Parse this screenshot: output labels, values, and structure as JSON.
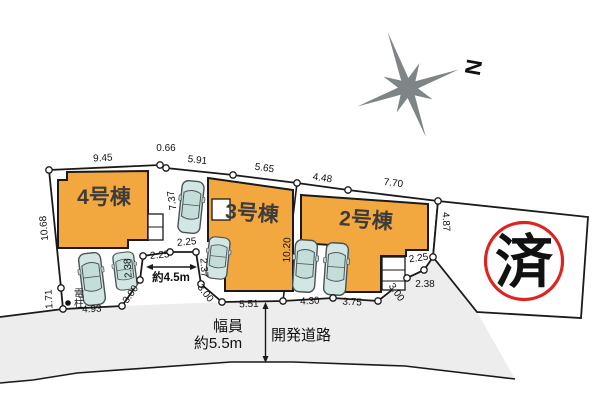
{
  "plan": {
    "buildings": [
      {
        "label": "4号棟"
      },
      {
        "label": "3号棟"
      },
      {
        "label": "2号棟"
      }
    ],
    "stamp": {
      "label": "済"
    },
    "compass": {
      "label": "N"
    },
    "road": {
      "width_caption_line1": "幅員",
      "width_caption_line2": "約5.5m",
      "name": "開発道路"
    },
    "utility_pole_label": "電柱",
    "driveway_width_label": "約4.5m",
    "dims": {
      "d945": "9.45",
      "d066": "0.66",
      "d591": "5.91",
      "d565": "5.65",
      "d448": "4.48",
      "d770": "7.70",
      "d1068": "10.68",
      "d171": "1.71",
      "d493": "4.93",
      "d737": "7.37",
      "d238l": "2.38",
      "d300l": "3.00",
      "d225l": "2.25",
      "d225t": "2.25",
      "d237": "2.37",
      "d300m": "3.00",
      "d551": "5.51",
      "d430": "4.30",
      "d375": "3.75",
      "d300r": "3.00",
      "d238r": "2.38",
      "d225r": "2.25",
      "d1020": "10.20",
      "d487": "4.87"
    },
    "colors": {
      "building": "#f3a73f",
      "road": "#ededed",
      "car": "#d2e7e4",
      "stamp": "#dd2420",
      "compass": "#7f8487",
      "line": "#1a1a1a"
    }
  }
}
